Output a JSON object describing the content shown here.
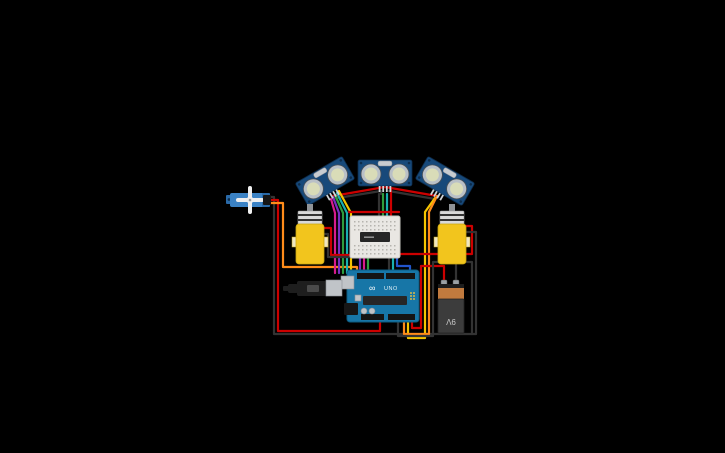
{
  "app": {
    "name": "circuit-canvas",
    "background": "#000000"
  },
  "colors": {
    "bg": "#000000",
    "sensor_board": "#17497a",
    "sensor_ring": "#b9c0c7",
    "sensor_face": "#d9dcb8",
    "sensor_crystal": "#c8ccd0",
    "servo_body": "#3b82c4",
    "servo_dark": "#2a6aa8",
    "servo_horn": "#efefef",
    "motor_body": "#f2c51d",
    "motor_cap": "#d9d9d9",
    "breadboard": "#e9e7e3",
    "chip": "#262626",
    "arduino": "#1776a7",
    "silver": "#c0c4c8",
    "battery_body": "#3c3c3c",
    "battery_band": "#c07a3e",
    "plug": "#1e1e1e"
  },
  "labels": {
    "battery": "9V",
    "arduino_model": "UNO",
    "arduino_logo": "∞"
  },
  "components": [
    {
      "name": "micro-servo",
      "cx": 252,
      "cy": 200
    },
    {
      "name": "ultrasonic-sensor-left",
      "cx": 325,
      "cy": 181,
      "rotation": -30
    },
    {
      "name": "ultrasonic-sensor-center",
      "cx": 385,
      "cy": 173,
      "rotation": 0
    },
    {
      "name": "ultrasonic-sensor-right",
      "cx": 445,
      "cy": 181,
      "rotation": 30
    },
    {
      "name": "dc-motor-left",
      "cx": 310,
      "cy": 240
    },
    {
      "name": "dc-motor-right",
      "cx": 452,
      "cy": 240
    },
    {
      "name": "mini-breadboard",
      "cx": 375,
      "cy": 237
    },
    {
      "name": "motor-driver-chip",
      "cx": 375,
      "cy": 237
    },
    {
      "name": "arduino-uno",
      "cx": 383,
      "cy": 296
    },
    {
      "name": "battery-9v",
      "cx": 451,
      "cy": 307
    },
    {
      "name": "power-plug",
      "cx": 312,
      "cy": 288
    }
  ],
  "wires": [
    {
      "name": "wire-servo-black",
      "color": "#333333",
      "pts": [
        [
          268,
          197
        ],
        [
          274,
          197
        ],
        [
          274,
          334
        ],
        [
          472,
          334
        ],
        [
          472,
          262
        ],
        [
          467,
          262
        ]
      ]
    },
    {
      "name": "wire-servo-red",
      "color": "#cc0000",
      "pts": [
        [
          268,
          200
        ],
        [
          278,
          200
        ],
        [
          278,
          331
        ],
        [
          380,
          331
        ],
        [
          380,
          321
        ]
      ]
    },
    {
      "name": "wire-servo-signal",
      "color": "#ff8c1a",
      "pts": [
        [
          268,
          203
        ],
        [
          283,
          203
        ],
        [
          283,
          267
        ],
        [
          357,
          267
        ],
        [
          357,
          275
        ]
      ]
    },
    {
      "name": "wire-sensor-vcc-left",
      "color": "#cc0000",
      "pts": [
        [
          333,
          196
        ],
        [
          385,
          187
        ]
      ]
    },
    {
      "name": "wire-sensor-vcc-right",
      "color": "#cc0000",
      "pts": [
        [
          385,
          187
        ],
        [
          437,
          196
        ]
      ]
    },
    {
      "name": "wire-sensor-gnd-left",
      "color": "#333333",
      "pts": [
        [
          331,
          199
        ],
        [
          381,
          191
        ],
        [
          381,
          194
        ]
      ]
    },
    {
      "name": "wire-sensor-gnd-right",
      "color": "#333333",
      "pts": [
        [
          389,
          191
        ],
        [
          435,
          199
        ]
      ]
    },
    {
      "name": "wire-center-gnd",
      "color": "#333333",
      "pts": [
        [
          379,
          194
        ],
        [
          379,
          218
        ]
      ]
    },
    {
      "name": "wire-center-trig",
      "color": "#2e9e3e",
      "pts": [
        [
          383,
          194
        ],
        [
          383,
          218
        ]
      ]
    },
    {
      "name": "wire-center-echo",
      "color": "#19b0b0",
      "pts": [
        [
          387,
          194
        ],
        [
          387,
          218
        ]
      ]
    },
    {
      "name": "wire-center-vcc",
      "color": "#cc0000",
      "pts": [
        [
          391,
          190
        ],
        [
          391,
          218
        ]
      ]
    },
    {
      "name": "wire-left-sig-magenta",
      "color": "#d81b8c",
      "pts": [
        [
          331,
          199
        ],
        [
          335,
          213
        ],
        [
          335,
          273
        ]
      ]
    },
    {
      "name": "wire-left-sig-purple",
      "color": "#7a2fc1",
      "pts": [
        [
          333,
          197
        ],
        [
          339,
          213
        ],
        [
          339,
          273
        ]
      ]
    },
    {
      "name": "wire-left-sig-green",
      "color": "#2e9e3e",
      "pts": [
        [
          335,
          195
        ],
        [
          343,
          213
        ],
        [
          343,
          273
        ]
      ]
    },
    {
      "name": "wire-left-sig-cyan",
      "color": "#19b0b0",
      "pts": [
        [
          337,
          193
        ],
        [
          347,
          213
        ],
        [
          347,
          273
        ]
      ]
    },
    {
      "name": "wire-left-sig-yellow",
      "color": "#f5c400",
      "pts": [
        [
          339,
          191
        ],
        [
          351,
          213
        ],
        [
          351,
          273
        ]
      ]
    },
    {
      "name": "wire-right-sig-yellow",
      "color": "#f5c400",
      "pts": [
        [
          435,
          198
        ],
        [
          425,
          212
        ],
        [
          425,
          338
        ],
        [
          408,
          338
        ],
        [
          408,
          320
        ]
      ]
    },
    {
      "name": "wire-right-sig-orange",
      "color": "#ff8c1a",
      "pts": [
        [
          437,
          196
        ],
        [
          429,
          212
        ],
        [
          429,
          334
        ],
        [
          404,
          334
        ],
        [
          404,
          320
        ]
      ]
    },
    {
      "name": "wire-battery-positive",
      "color": "#cc0000",
      "pts": [
        [
          444,
          284
        ],
        [
          444,
          266
        ],
        [
          421,
          266
        ],
        [
          421,
          328
        ],
        [
          412,
          328
        ],
        [
          412,
          320
        ]
      ]
    },
    {
      "name": "wire-battery-negative",
      "color": "#333333",
      "pts": [
        [
          456,
          284
        ],
        [
          456,
          262
        ],
        [
          433,
          262
        ],
        [
          433,
          336
        ],
        [
          398,
          336
        ],
        [
          398,
          320
        ]
      ]
    },
    {
      "name": "wire-left-motor-red",
      "color": "#cc0000",
      "pts": [
        [
          322,
          228
        ],
        [
          331,
          228
        ],
        [
          331,
          255
        ],
        [
          353,
          255
        ]
      ]
    },
    {
      "name": "wire-left-motor-black",
      "color": "#333333",
      "pts": [
        [
          322,
          234
        ],
        [
          328,
          234
        ],
        [
          328,
          257
        ],
        [
          353,
          257
        ]
      ]
    },
    {
      "name": "wire-right-motor-red",
      "color": "#cc0000",
      "pts": [
        [
          466,
          226
        ],
        [
          472,
          226
        ],
        [
          472,
          254
        ],
        [
          398,
          254
        ]
      ]
    },
    {
      "name": "wire-right-motor-black",
      "color": "#333333",
      "pts": [
        [
          466,
          232
        ],
        [
          476,
          232
        ],
        [
          476,
          334
        ],
        [
          472,
          334
        ]
      ]
    },
    {
      "name": "wire-bb-purple",
      "color": "#7a2fc1",
      "pts": [
        [
          360,
          257
        ],
        [
          360,
          274
        ]
      ]
    },
    {
      "name": "wire-bb-magenta",
      "color": "#d81b8c",
      "pts": [
        [
          364,
          257
        ],
        [
          364,
          274
        ]
      ]
    },
    {
      "name": "wire-bb-green",
      "color": "#2e9e3e",
      "pts": [
        [
          368,
          257
        ],
        [
          368,
          274
        ]
      ]
    },
    {
      "name": "wire-bb-black",
      "color": "#333333",
      "pts": [
        [
          389,
          257
        ],
        [
          389,
          274
        ]
      ]
    },
    {
      "name": "wire-bb-cyan",
      "color": "#19b0b0",
      "pts": [
        [
          393,
          257
        ],
        [
          393,
          274
        ]
      ]
    },
    {
      "name": "wire-bb-blue",
      "color": "#2255cc",
      "pts": [
        [
          397,
          257
        ],
        [
          397,
          266
        ],
        [
          410,
          266
        ],
        [
          410,
          274
        ]
      ]
    },
    {
      "name": "wire-bb-rail-red",
      "color": "#cc0000",
      "pts": [
        [
          349,
          212
        ],
        [
          399,
          212
        ]
      ]
    }
  ]
}
